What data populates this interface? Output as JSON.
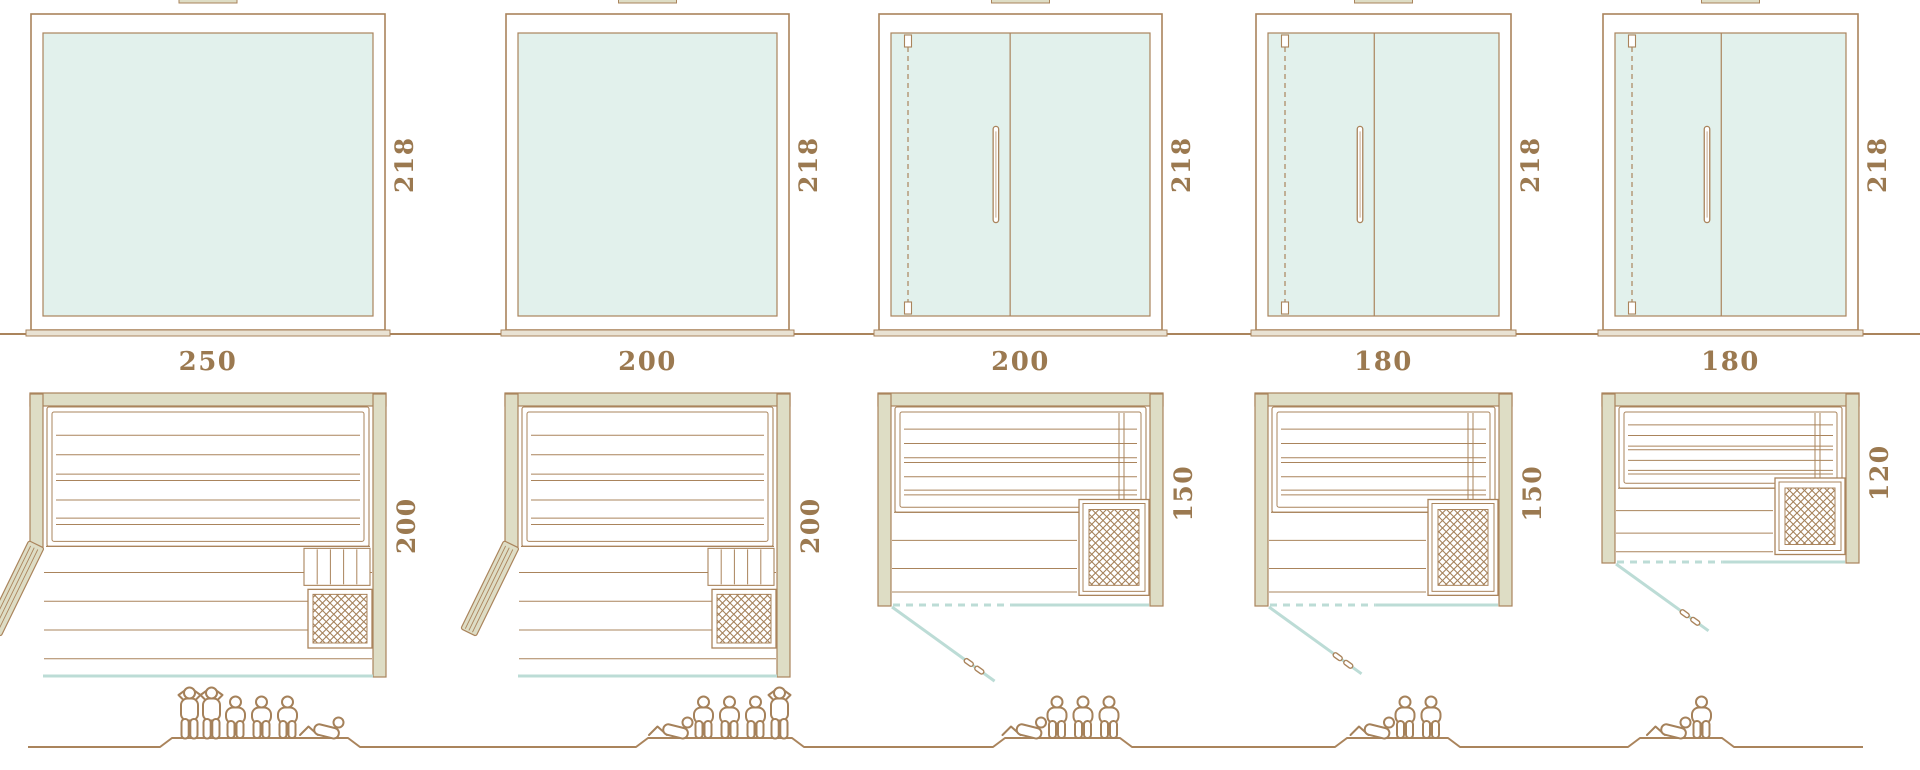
{
  "page": {
    "type": "product-size-comparison-diagram",
    "subject": "Glass-front sauna cabins: five sizes shown as front elevation, floor plan and capacity figures",
    "background": "#ffffff"
  },
  "colors": {
    "outline": "#aa845c",
    "label_text": "#9b7950",
    "wall_fill": "#deddc5",
    "sill_fill": "#e9e2d3",
    "glass_fill": "#e2f1ec",
    "glass_line": "#bcdcd6",
    "figure_outline": "#a5815a",
    "white": "#ffffff"
  },
  "models": [
    {
      "width": "250",
      "height": "218",
      "depth": "200",
      "front_elevation": "fixed glass panel",
      "floor_plan": {
        "entry": "hinged side door, left",
        "heater_position": "bottom-right",
        "front_wall": "glass"
      },
      "capacity_total": 6,
      "capacity_figures": [
        "standing",
        "standing",
        "sitting",
        "sitting",
        "sitting",
        "lying"
      ]
    },
    {
      "width": "200",
      "height": "218",
      "depth": "200",
      "front_elevation": "fixed glass panel",
      "floor_plan": {
        "entry": "hinged side door, left",
        "heater_position": "bottom-right",
        "front_wall": "glass"
      },
      "capacity_total": 5,
      "capacity_figures": [
        "lying",
        "sitting",
        "sitting",
        "sitting",
        "standing"
      ]
    },
    {
      "width": "200",
      "height": "218",
      "depth": "150",
      "front_elevation": "glass front with hinged door, vertical handle and hinge line",
      "floor_plan": {
        "entry": "front glass door shown open with swing line",
        "heater_position": "bottom-right",
        "front_wall": "glass"
      },
      "capacity_total": 4,
      "capacity_figures": [
        "lying",
        "sitting",
        "sitting",
        "sitting"
      ]
    },
    {
      "width": "180",
      "height": "218",
      "depth": "150",
      "front_elevation": "glass front with hinged door, vertical handle and hinge line",
      "floor_plan": {
        "entry": "front glass door shown open with swing line",
        "heater_position": "bottom-right",
        "front_wall": "glass"
      },
      "capacity_total": 3,
      "capacity_figures": [
        "lying",
        "sitting",
        "sitting"
      ]
    },
    {
      "width": "180",
      "height": "218",
      "depth": "120",
      "front_elevation": "glass front with hinged door, vertical handle and hinge line",
      "floor_plan": {
        "entry": "front glass door shown open with swing line",
        "heater_position": "bottom-right",
        "front_wall": "glass"
      },
      "capacity_total": 2,
      "capacity_figures": [
        "lying",
        "sitting"
      ]
    }
  ]
}
